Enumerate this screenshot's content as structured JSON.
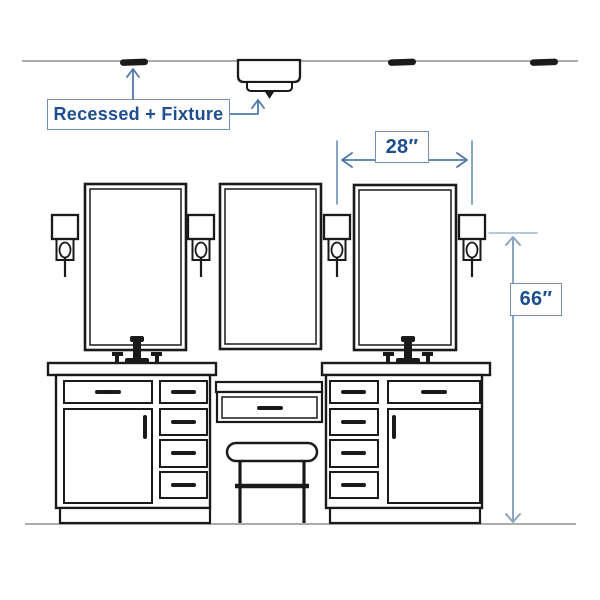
{
  "page": {
    "background": "#ffffff",
    "description": "Hand-sketched elevation of a double bathroom vanity with three framed mirrors, four wall sconces, three recessed ceiling lights, one surface-mounted ceiling fixture, a center makeup counter with stool, annotated with lighting placement dimensions"
  },
  "colors": {
    "sketch_line": "#1a1a1a",
    "guide_line": "#8f8f8f",
    "label_text": "#1d4e8f",
    "label_border": "#7191bd",
    "dimension_arrow": "#4f79ab",
    "dimension_line_light": "#8aa6bf"
  },
  "callout": {
    "text": "Recessed + Fixture"
  },
  "dimensions": {
    "sconce_spacing": "28″",
    "sconce_height": "66″"
  },
  "diagram": {
    "elements": [
      "ceiling-line",
      "recessed-light x3",
      "flush-mount-fixture",
      "mirror x3",
      "wall-sconce x4",
      "left-vanity-cabinet",
      "right-vanity-cabinet",
      "faucet x2",
      "makeup-counter-drawer",
      "vanity-stool",
      "floor-line"
    ]
  }
}
